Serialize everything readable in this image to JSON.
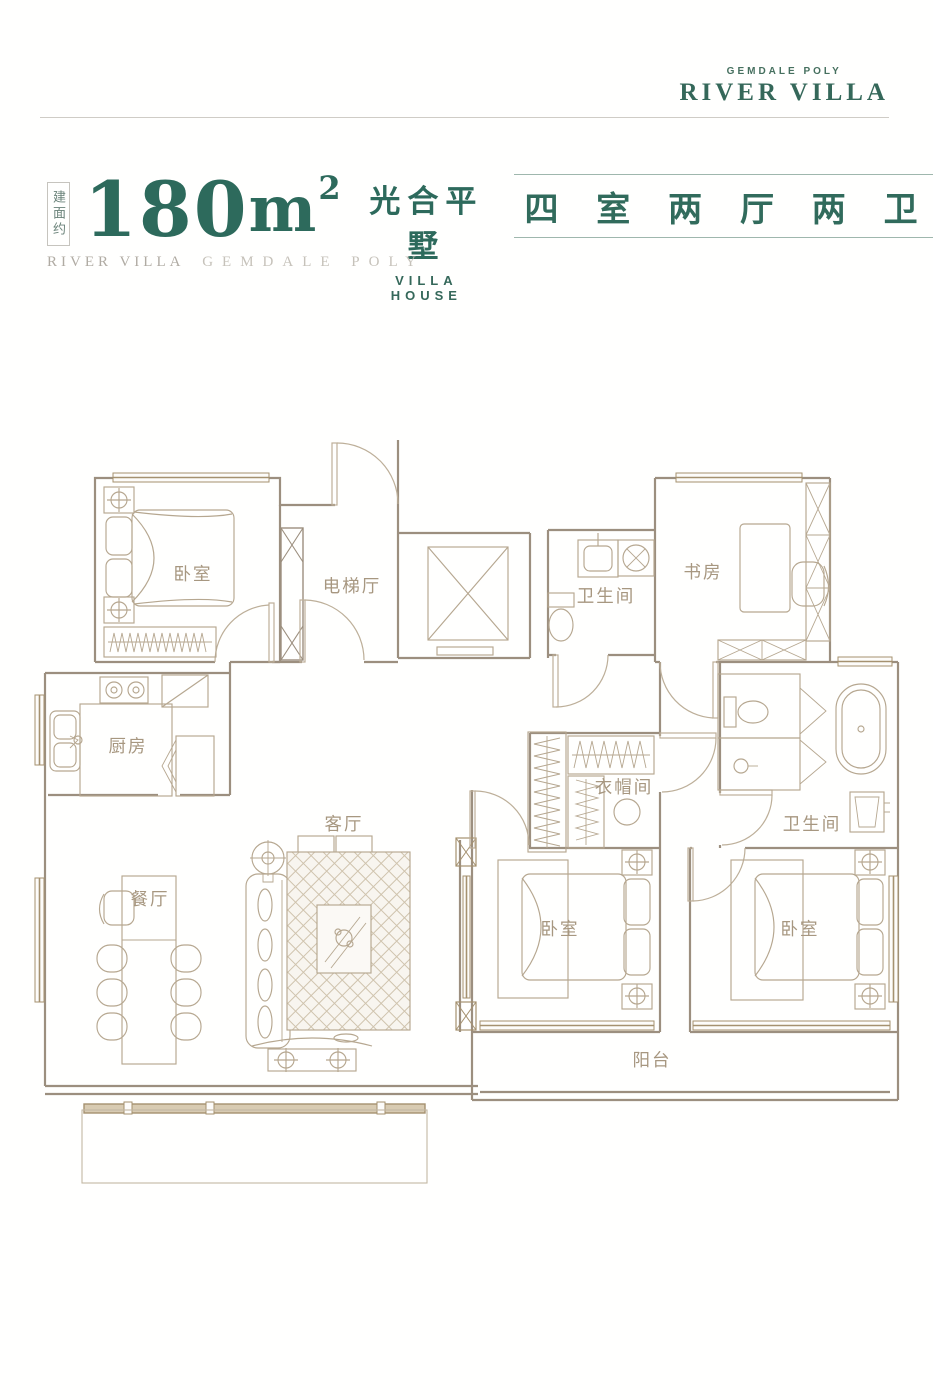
{
  "brand": {
    "tagline": "GEMDALE POLY",
    "name": "RIVER VILLA"
  },
  "header": {
    "badge_vertical": "建面约",
    "area_value": "180",
    "area_unit": "m",
    "area_exponent": "2",
    "product_cn": "光合平墅",
    "product_en": "VILLA HOUSE",
    "layout_spec": "四 室 两 厅 两 卫",
    "subtitle_left": "RIVER VILLA",
    "subtitle_right": "GEMDALE POLY"
  },
  "floorplan": {
    "rooms": [
      {
        "id": "bedroom-top-left",
        "label": "卧室"
      },
      {
        "id": "elevator-hall",
        "label": "电梯厅"
      },
      {
        "id": "bathroom-top",
        "label": "卫生间"
      },
      {
        "id": "study",
        "label": "书房"
      },
      {
        "id": "kitchen",
        "label": "厨房"
      },
      {
        "id": "cloakroom",
        "label": "衣帽间"
      },
      {
        "id": "living-room",
        "label": "客厅"
      },
      {
        "id": "bathroom-right",
        "label": "卫生间"
      },
      {
        "id": "dining-room",
        "label": "餐厅"
      },
      {
        "id": "bedroom-middle",
        "label": "卧室"
      },
      {
        "id": "bedroom-right",
        "label": "卧室"
      },
      {
        "id": "balcony",
        "label": "阳台"
      }
    ]
  },
  "colors": {
    "brand_green": "#2d6a5c",
    "plan_wall": "#9c8f7f",
    "plan_furniture": "#b6a790",
    "plan_window": "#a5916f",
    "subtitle_gray": "#b0aba3"
  }
}
